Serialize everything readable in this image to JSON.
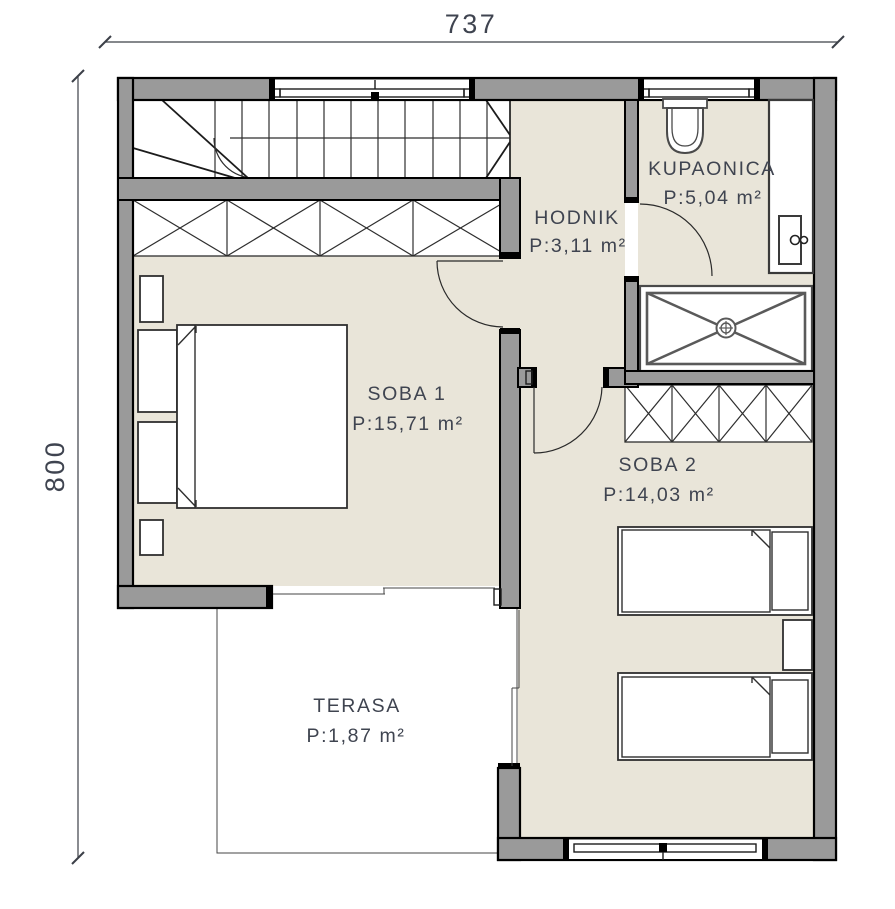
{
  "type": "architectural-floor-plan",
  "dimension_labels": {
    "width": "737",
    "height": "800"
  },
  "rooms": [
    {
      "id": "hodnik",
      "name": "HODNIK",
      "area": "P:3,11 m²"
    },
    {
      "id": "kupaonica",
      "name": "KUPAONICA",
      "area": "P:5,04 m²"
    },
    {
      "id": "soba1",
      "name": "SOBA 1",
      "area": "P:15,71 m²"
    },
    {
      "id": "soba2",
      "name": "SOBA 2",
      "area": "P:14,03 m²"
    },
    {
      "id": "terasa",
      "name": "TERASA",
      "area": "P:1,87 m²"
    }
  ],
  "fixtures": [
    "stairs",
    "wardrobe",
    "toilet",
    "vanity-sink",
    "shower-tray",
    "double-bed",
    "single-bed",
    "nightstand",
    "swing-door",
    "sliding-door",
    "window"
  ],
  "colors": {
    "floor_beige": "#e9e5d9",
    "wall_gray": "#9a9a9a",
    "outline_black": "#000000",
    "line_dark": "#2e2e2e",
    "text": "#3f4450",
    "background": "#ffffff"
  }
}
